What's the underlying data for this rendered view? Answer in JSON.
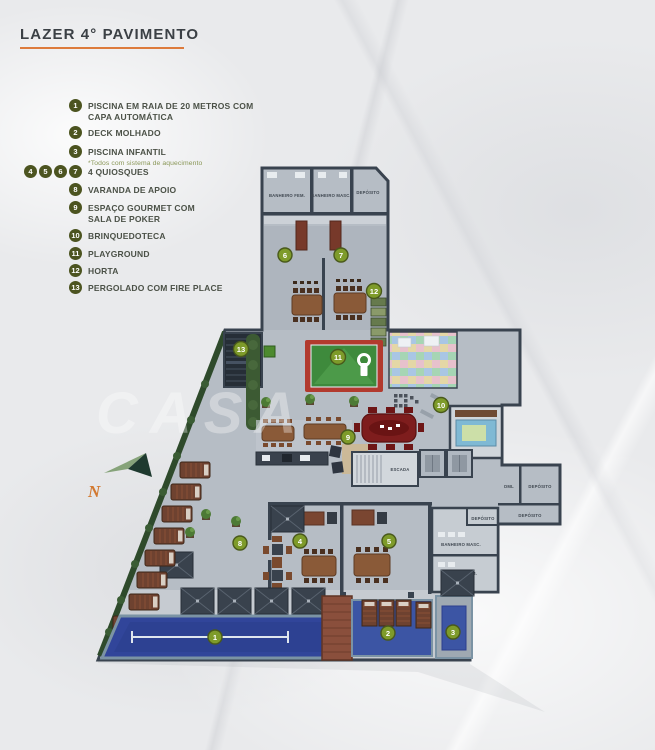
{
  "title": "LAZER 4° PAVIMENTO",
  "legend": [
    {
      "nums": [
        "1"
      ],
      "label": "PISCINA EM RAIA DE 20 METROS COM CAPA AUTOMÁTICA"
    },
    {
      "nums": [
        "2"
      ],
      "label": "DECK MOLHADO"
    },
    {
      "nums": [
        "3"
      ],
      "label": "PISCINA INFANTIL",
      "note": "*Todos com sistema de aquecimento"
    },
    {
      "nums": [
        "4",
        "5",
        "6",
        "7"
      ],
      "label": "4 QUIOSQUES"
    },
    {
      "nums": [
        "8"
      ],
      "label": "VARANDA DE APOIO"
    },
    {
      "nums": [
        "9"
      ],
      "label": "ESPAÇO GOURMET COM SALA DE POKER"
    },
    {
      "nums": [
        "10"
      ],
      "label": "BRINQUEDOTECA"
    },
    {
      "nums": [
        "11"
      ],
      "label": "PLAYGROUND"
    },
    {
      "nums": [
        "12"
      ],
      "label": "HORTA"
    },
    {
      "nums": [
        "13"
      ],
      "label": "PERGOLADO COM FIRE PLACE"
    }
  ],
  "compass": {
    "north": "N"
  },
  "watermark": "CASA",
  "plan": {
    "markers": [
      {
        "n": "1"
      },
      {
        "n": "2"
      },
      {
        "n": "3"
      },
      {
        "n": "4"
      },
      {
        "n": "5"
      },
      {
        "n": "6"
      },
      {
        "n": "7"
      },
      {
        "n": "8"
      },
      {
        "n": "9"
      },
      {
        "n": "10"
      },
      {
        "n": "11"
      },
      {
        "n": "12"
      },
      {
        "n": "13"
      }
    ],
    "rooms": {
      "banheiro_fem_top": "BANHEIRO FEM.",
      "banheiro_masc_top": "BANHEIRO MASC.",
      "deposito_top": "DEPÓSITO",
      "escada": "ESCADA",
      "dml": "DML",
      "deposito_right_1": "DEPÓSITO",
      "deposito_right_2": "DEPÓSITO",
      "deposito_right_3": "DEPÓSITO",
      "banheiro_masc_bottom": "BANHEIRO MASC.",
      "banheiro_fem_bottom": "BANHEIRO FEM."
    }
  },
  "colors": {
    "accent_orange": "#dd7b3c",
    "legend_olive": "#4c5420",
    "marker_green": "#7e9b2a",
    "wall": "#39434f",
    "floor": "#b6bdc5",
    "pool_blue": "#31459a",
    "deck_blue": "#3c55a4",
    "playground_red": "#b23a2e",
    "playground_green": "#3e8a3c",
    "wood_brown": "#8a5a38",
    "lounger_brown": "#6e4230"
  }
}
